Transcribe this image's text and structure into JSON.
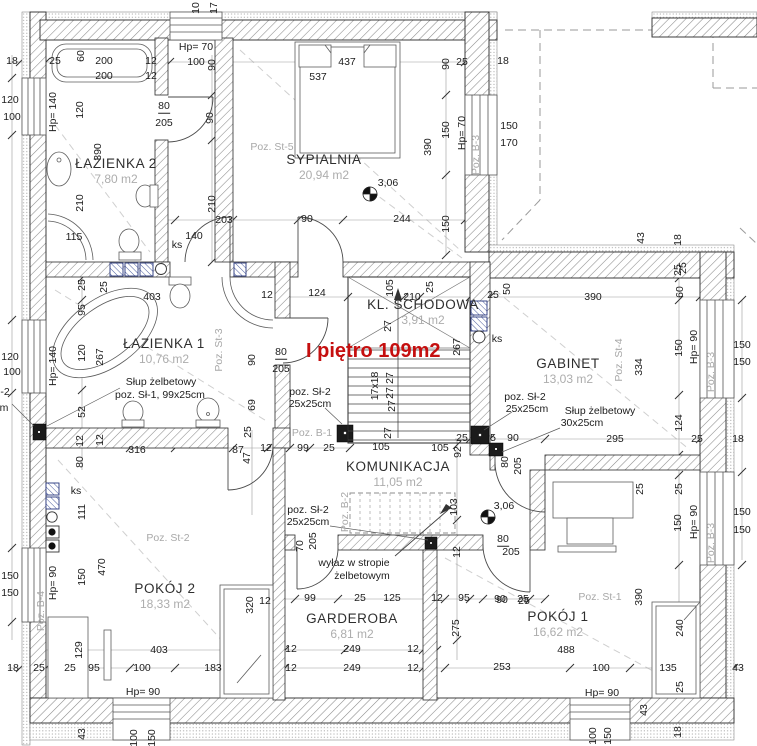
{
  "title": {
    "text": "I piętro 109m2",
    "color": "#c50f0f"
  },
  "rooms": [
    {
      "name": "ŁAZIENKA 2",
      "area": "7,80 m2",
      "x": 116,
      "y": 171
    },
    {
      "name": "SYPIALNIA",
      "area": "20,94 m2",
      "x": 324,
      "y": 167
    },
    {
      "name": "ŁAZIENKA 1",
      "area": "10,76 m2",
      "x": 164,
      "y": 351
    },
    {
      "name": "KL. SCHODOWA",
      "area": "3,91 m2",
      "x": 423,
      "y": 312
    },
    {
      "name": "GABINET",
      "area": "13,03 m2",
      "x": 568,
      "y": 371
    },
    {
      "name": "KOMUNIKACJA",
      "area": "11,05 m2",
      "x": 398,
      "y": 474
    },
    {
      "name": "POKÓJ 2",
      "area": "18,33 m2",
      "x": 165,
      "y": 596
    },
    {
      "name": "GARDEROBA",
      "area": "6,81 m2",
      "x": 352,
      "y": 626
    },
    {
      "name": "POKÓJ 1",
      "area": "16,62 m2",
      "x": 558,
      "y": 624
    }
  ],
  "labels": [
    [
      "10",
      196,
      8,
      -90
    ],
    [
      "17",
      214,
      8,
      -90
    ],
    [
      "18",
      12,
      61
    ],
    [
      "25",
      55,
      61
    ],
    [
      "60",
      81,
      56,
      -90
    ],
    [
      "200",
      104,
      61
    ],
    [
      "12",
      151,
      61
    ],
    [
      "200",
      104,
      76
    ],
    [
      "12",
      151,
      76
    ],
    [
      "Hp= 70",
      196,
      47
    ],
    [
      "100",
      196,
      62
    ],
    [
      "90",
      212,
      65,
      -90
    ],
    [
      "80",
      164,
      107,
      0,
      "ov"
    ],
    [
      "205",
      164,
      123
    ],
    [
      "90",
      210,
      118,
      -90
    ],
    [
      "120",
      10,
      100
    ],
    [
      "100",
      12,
      117
    ],
    [
      "Hp= 140",
      53,
      112,
      -90
    ],
    [
      "120",
      80,
      110,
      -90
    ],
    [
      "390",
      98,
      152,
      -90
    ],
    [
      "210",
      80,
      203,
      -90
    ],
    [
      "115",
      74,
      237
    ],
    [
      "437",
      347,
      62
    ],
    [
      "537",
      318,
      77
    ],
    [
      "90",
      446,
      64,
      -90
    ],
    [
      "25",
      462,
      62
    ],
    [
      "18",
      503,
      61
    ],
    [
      "Poz. St-5",
      272,
      147,
      0,
      "g"
    ],
    [
      "390",
      428,
      147,
      -90
    ],
    [
      "150",
      446,
      130,
      -90
    ],
    [
      "Hp= 70",
      462,
      133,
      -90
    ],
    [
      "Poz. B-3",
      476,
      155,
      -90,
      "g"
    ],
    [
      "150",
      509,
      126
    ],
    [
      "170",
      509,
      143
    ],
    [
      "150",
      446,
      224,
      -90
    ],
    [
      "210",
      212,
      204,
      -90
    ],
    [
      "203",
      224,
      220
    ],
    [
      "90",
      307,
      219
    ],
    [
      "244",
      402,
      219
    ],
    [
      "140",
      194,
      236
    ],
    [
      "ks",
      177,
      245
    ],
    [
      "3,06",
      388,
      183
    ],
    [
      "43",
      641,
      238,
      -90
    ],
    [
      "18",
      678,
      240,
      -90
    ],
    [
      "25",
      683,
      268,
      -90
    ],
    [
      "403",
      152,
      297
    ],
    [
      "12",
      267,
      295
    ],
    [
      "25",
      82,
      285,
      -90
    ],
    [
      "25",
      104,
      287,
      -90
    ],
    [
      "95",
      82,
      310,
      -90
    ],
    [
      "120",
      82,
      353,
      -90
    ],
    [
      "267",
      100,
      357,
      -90
    ],
    [
      "120",
      10,
      357
    ],
    [
      "100",
      12,
      372
    ],
    [
      "Hp= 140",
      53,
      366,
      -90
    ],
    [
      "Słup żelbetowy",
      161,
      382
    ],
    [
      "poz. Sł-1, 99x25cm",
      160,
      395
    ],
    [
      "52",
      82,
      412,
      -90
    ],
    [
      "80",
      281,
      353,
      0,
      "ov"
    ],
    [
      "205",
      281,
      369
    ],
    [
      "90",
      252,
      360,
      -90
    ],
    [
      "69",
      252,
      405,
      -90
    ],
    [
      "Poz. St-3",
      219,
      350,
      -90,
      "g"
    ],
    [
      "124",
      317,
      293
    ],
    [
      "105",
      390,
      288,
      -90
    ],
    [
      "210",
      412,
      297
    ],
    [
      "25",
      430,
      287,
      -90
    ],
    [
      "50",
      507,
      289,
      -90
    ],
    [
      "25",
      493,
      295
    ],
    [
      "267",
      457,
      347,
      -90
    ],
    [
      "27",
      388,
      326,
      -90
    ],
    [
      "17x18",
      375,
      386,
      -90
    ],
    [
      "27",
      390,
      378,
      -90
    ],
    [
      "27",
      390,
      393,
      -90
    ],
    [
      "27",
      392,
      406,
      -90
    ],
    [
      "27",
      388,
      433,
      -90
    ],
    [
      "ks",
      497,
      339
    ],
    [
      "poz. Sł-2",
      310,
      392
    ],
    [
      "25x25cm",
      310,
      404
    ],
    [
      "Poz. B-1",
      312,
      433,
      0,
      "g"
    ],
    [
      "390",
      593,
      297
    ],
    [
      "60",
      680,
      292,
      -90
    ],
    [
      "25",
      678,
      270,
      -90
    ],
    [
      "334",
      639,
      367,
      -90
    ],
    [
      "150",
      679,
      348,
      -90
    ],
    [
      "Hp= 90",
      694,
      347,
      -90
    ],
    [
      "Poz. B-3",
      711,
      372,
      -90,
      "g"
    ],
    [
      "150",
      742,
      345
    ],
    [
      "150",
      742,
      362
    ],
    [
      "Poz. St-4",
      619,
      360,
      -90,
      "g"
    ],
    [
      "poz. Sł-2",
      525,
      397
    ],
    [
      "25x25cm",
      527,
      409
    ],
    [
      "Słup żelbetowy",
      600,
      411
    ],
    [
      "30x25cm",
      582,
      423
    ],
    [
      "124",
      679,
      423,
      -90
    ],
    [
      "295",
      615,
      439
    ],
    [
      "25",
      697,
      439
    ],
    [
      "18",
      738,
      439
    ],
    [
      "-2",
      5,
      392
    ],
    [
      "m",
      4,
      408
    ],
    [
      "25",
      248,
      432,
      -90
    ],
    [
      "316",
      137,
      450
    ],
    [
      "87",
      238,
      450
    ],
    [
      "12",
      266,
      448
    ],
    [
      "47",
      247,
      458,
      -90
    ],
    [
      "99",
      303,
      448
    ],
    [
      "12",
      80,
      441,
      -90
    ],
    [
      "12",
      100,
      440,
      -90
    ],
    [
      "80",
      80,
      462,
      -90
    ],
    [
      "25",
      329,
      448
    ],
    [
      "105",
      381,
      447
    ],
    [
      "105",
      440,
      448
    ],
    [
      "92",
      458,
      452,
      -90
    ],
    [
      "25",
      462,
      438
    ],
    [
      "5",
      493,
      438
    ],
    [
      "90",
      513,
      438
    ],
    [
      "103",
      454,
      507,
      -90
    ],
    [
      "3,06",
      504,
      506
    ],
    [
      "poz. Sł-2",
      308,
      510
    ],
    [
      "25x25cm",
      308,
      522
    ],
    [
      "Poz. B-2",
      345,
      512,
      -90,
      "g"
    ],
    [
      "70",
      300,
      546,
      -90
    ],
    [
      "205",
      313,
      541,
      -90
    ],
    [
      "wyłaz w stropie",
      354,
      563
    ],
    [
      "żelbetowym",
      362,
      576
    ],
    [
      "12",
      457,
      552,
      -90
    ],
    [
      "80",
      503,
      540,
      0,
      "ov"
    ],
    [
      "205",
      511,
      552
    ],
    [
      "80",
      505,
      462,
      -90
    ],
    [
      "205",
      518,
      466,
      -90
    ],
    [
      "99",
      310,
      598
    ],
    [
      "25",
      360,
      598
    ],
    [
      "125",
      392,
      598
    ],
    [
      "12",
      437,
      598
    ],
    [
      "95",
      464,
      598
    ],
    [
      "90",
      500,
      599
    ],
    [
      "25",
      523,
      599
    ],
    [
      "ks",
      76,
      491
    ],
    [
      "111",
      82,
      512,
      -90
    ],
    [
      "150",
      10,
      576
    ],
    [
      "150",
      10,
      593
    ],
    [
      "Hp= 90",
      53,
      583,
      -90
    ],
    [
      "Poz. B-4",
      41,
      611,
      -90,
      "g"
    ],
    [
      "150",
      82,
      577,
      -90
    ],
    [
      "470",
      102,
      567,
      -90
    ],
    [
      "Poz. St-2",
      168,
      538,
      0,
      "g"
    ],
    [
      "129",
      79,
      650,
      -90
    ],
    [
      "403",
      159,
      650
    ],
    [
      "320",
      250,
      605,
      -90
    ],
    [
      "12",
      265,
      601
    ],
    [
      "275",
      456,
      628,
      -90
    ],
    [
      "12",
      291,
      649
    ],
    [
      "249",
      352,
      649
    ],
    [
      "12",
      413,
      649
    ],
    [
      "12",
      291,
      668
    ],
    [
      "249",
      352,
      668
    ],
    [
      "12",
      413,
      668
    ],
    [
      "183",
      213,
      668
    ],
    [
      "25",
      640,
      489,
      -90
    ],
    [
      "25",
      679,
      489,
      -90
    ],
    [
      "150",
      678,
      523,
      -90
    ],
    [
      "Hp= 90",
      694,
      522,
      -90
    ],
    [
      "Poz. B-3",
      711,
      543,
      -90,
      "g"
    ],
    [
      "150",
      742,
      512
    ],
    [
      "150",
      742,
      530
    ],
    [
      "Poz. St-1",
      600,
      597,
      0,
      "g"
    ],
    [
      "390",
      639,
      597,
      -90
    ],
    [
      "240",
      680,
      628,
      -90
    ],
    [
      "90",
      502,
      600
    ],
    [
      "25",
      524,
      601
    ],
    [
      "488",
      566,
      650
    ],
    [
      "253",
      502,
      667
    ],
    [
      "100",
      601,
      668
    ],
    [
      "135",
      668,
      668
    ],
    [
      "43",
      738,
      668
    ],
    [
      "25",
      680,
      687,
      -90
    ],
    [
      "43",
      644,
      710,
      -90
    ],
    [
      "18",
      678,
      732,
      -90
    ],
    [
      "100",
      593,
      736,
      -90
    ],
    [
      "150",
      608,
      736,
      -90
    ],
    [
      "Hp= 90",
      602,
      693
    ],
    [
      "18",
      13,
      668
    ],
    [
      "25",
      39,
      668
    ],
    [
      "25",
      70,
      668
    ],
    [
      "95",
      94,
      668
    ],
    [
      "100",
      142,
      668
    ],
    [
      "Hp= 90",
      143,
      692
    ],
    [
      "43",
      82,
      734,
      -90
    ],
    [
      "100",
      134,
      738,
      -90
    ],
    [
      "150",
      152,
      738,
      -90
    ]
  ]
}
